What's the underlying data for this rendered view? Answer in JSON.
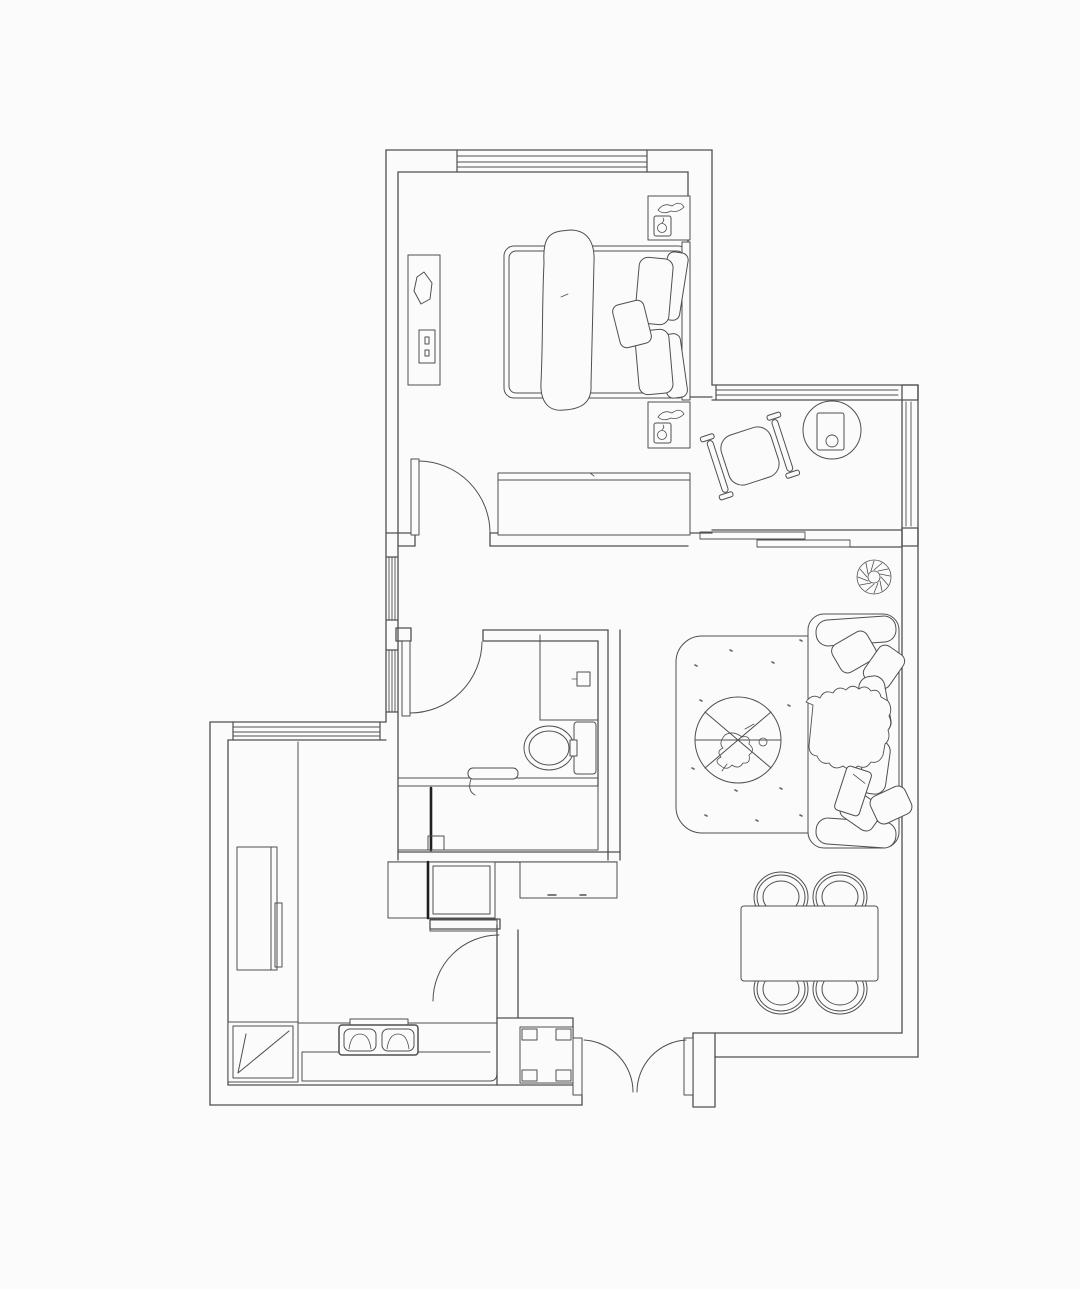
{
  "meta": {
    "type": "floor-plan",
    "style": "monochrome-line-drawing"
  },
  "colors": {
    "background": "#fbfbfb",
    "line": "#4f4f4f",
    "line_soft": "#6a6a6a",
    "accent_dark": "#1f1f1f"
  },
  "rooms": [
    {
      "id": "bedroom",
      "furniture": [
        "double-bed",
        "throw-blanket",
        "pillows",
        "headboard",
        "nightstand-upper",
        "nightstand-lower",
        "dresser",
        "wardrobe",
        "window-top",
        "window-left",
        "swing-door"
      ]
    },
    {
      "id": "balcony-study",
      "furniture": [
        "lounge-chair",
        "round-side-table",
        "window-top",
        "window-right",
        "sliding-door"
      ]
    },
    {
      "id": "bathroom",
      "furniture": [
        "shower-screen",
        "shower-head",
        "toilet",
        "vanity-counter",
        "faucet",
        "vanity-cabinet",
        "swing-door"
      ]
    },
    {
      "id": "hallway",
      "furniture": [
        "storage-cabinet",
        "console-cabinet",
        "shelf"
      ]
    },
    {
      "id": "kitchen",
      "furniture": [
        "window-top",
        "tall-cabinet",
        "side-counter",
        "corner-sink",
        "two-burner-stove",
        "base-counter",
        "swing-door"
      ]
    },
    {
      "id": "living-dining",
      "furniture": [
        "sofa",
        "sofa-cushions",
        "sofa-blanket",
        "area-rug",
        "round-coffee-table",
        "potted-plant",
        "dining-table",
        "dining-chairs",
        "double-entry-door",
        "structural-column"
      ]
    }
  ]
}
